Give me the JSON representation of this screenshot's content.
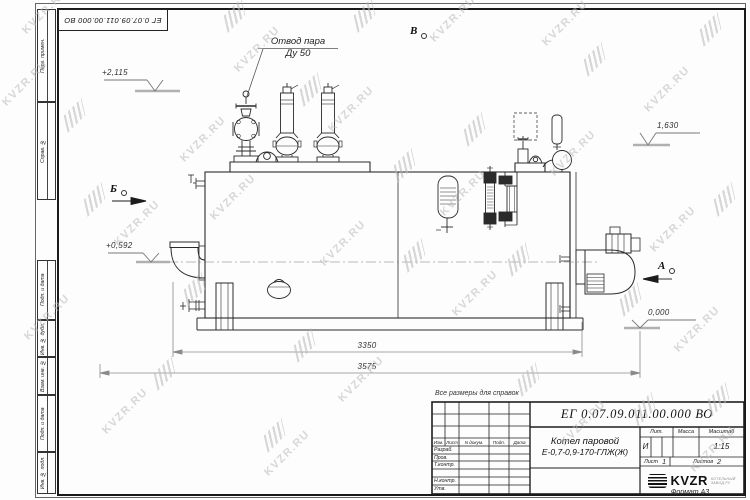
{
  "watermark": {
    "text": "KVZR.RU"
  },
  "frame": {
    "top_stamp_number": "ЕГ 0.07.09.011.00.000  ВО",
    "margin_stamps": [
      "Перв. примен.",
      "Справ. №",
      "Подп. и дата",
      "Инв. № дубл.",
      "Взам. инв. №",
      "Подп. и дата",
      "Инв. № подл."
    ],
    "format_note": "Формат А3"
  },
  "drawing": {
    "callout_line1": "Отвод пара",
    "callout_line2": "Ду 50",
    "elev_1": "+2,115",
    "elev_2": "1,630",
    "elev_3": "+0,592",
    "elev_4": "0,000",
    "view_b": "Б",
    "view_v": "В",
    "view_a": "А",
    "dim_1": "3350",
    "dim_2": "3575",
    "ref_note": "Все размеры для справок"
  },
  "title_block": {
    "doc_number": "ЕГ 0.07.09.011.00.000  ВО",
    "name_line1": "Котел паровой",
    "name_line2": "Е-0,7-0,9-170-ГЛЖ(Ж)",
    "cols": {
      "izm": "Изм.",
      "list": "Лист",
      "doc": "N докум.",
      "sign": "Подп.",
      "date": "Дата"
    },
    "rows": [
      "Разраб.",
      "Пров.",
      "Т.контр.",
      "",
      "Н.контр.",
      "Утв."
    ],
    "lit_label": "Лит.",
    "mass_label": "Масса",
    "scale_label": "Масштаб",
    "lit_value": "И",
    "scale_value": "1:15",
    "sheet_label": "Лист",
    "sheet_value": "1",
    "sheets_label": "Листов",
    "sheets_value": "2",
    "brand": "KVZR",
    "brand_sub1": "КОТЕЛЬНЫЙ",
    "brand_sub2": "ЗАВОД.РУ"
  }
}
